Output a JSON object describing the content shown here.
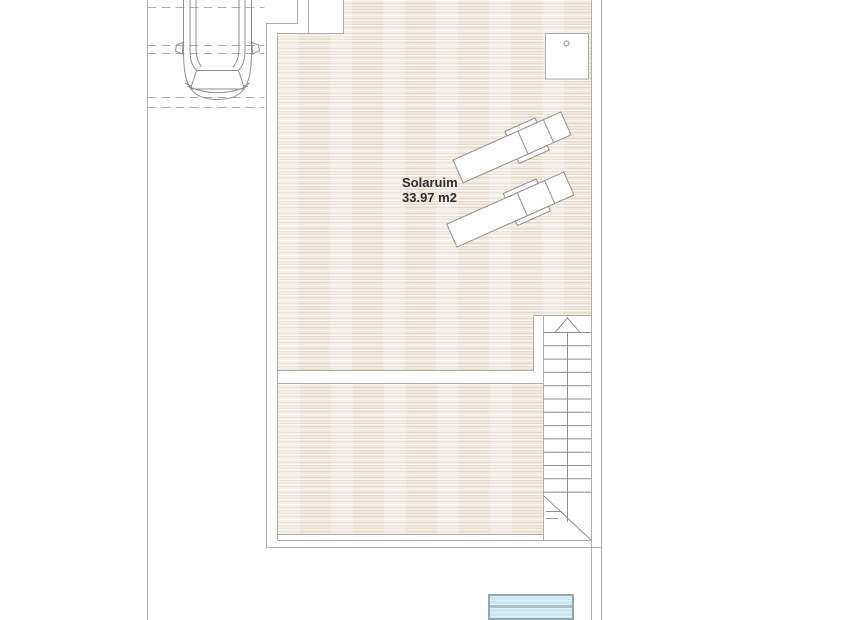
{
  "floorplan": {
    "room": {
      "name": "Solaruim",
      "area": "33.97 m2"
    },
    "elements": {
      "car": "car-plan-icon",
      "parking": "parking-dashed-lines",
      "sun_lounger": "sun-lounger-icon",
      "staircase": "staircase",
      "stair_direction": "stair-up-arrow-icon",
      "equipment_box": "rooftop-equipment-box",
      "pool": "swimming-pool"
    },
    "colors": {
      "line": "#adadad",
      "detail": "#8f8f8f",
      "deck_base": "#efe8de",
      "deck_stripe_dark": "#e3dacb",
      "deck_stripe_light": "#faf7f2",
      "pool_fill": "#cde7f0",
      "pool_stripe": "#e0f0f6",
      "pool_band": "#a6c3cb",
      "pool_border": "#8fa9b2",
      "text": "#2d2d2d"
    }
  }
}
